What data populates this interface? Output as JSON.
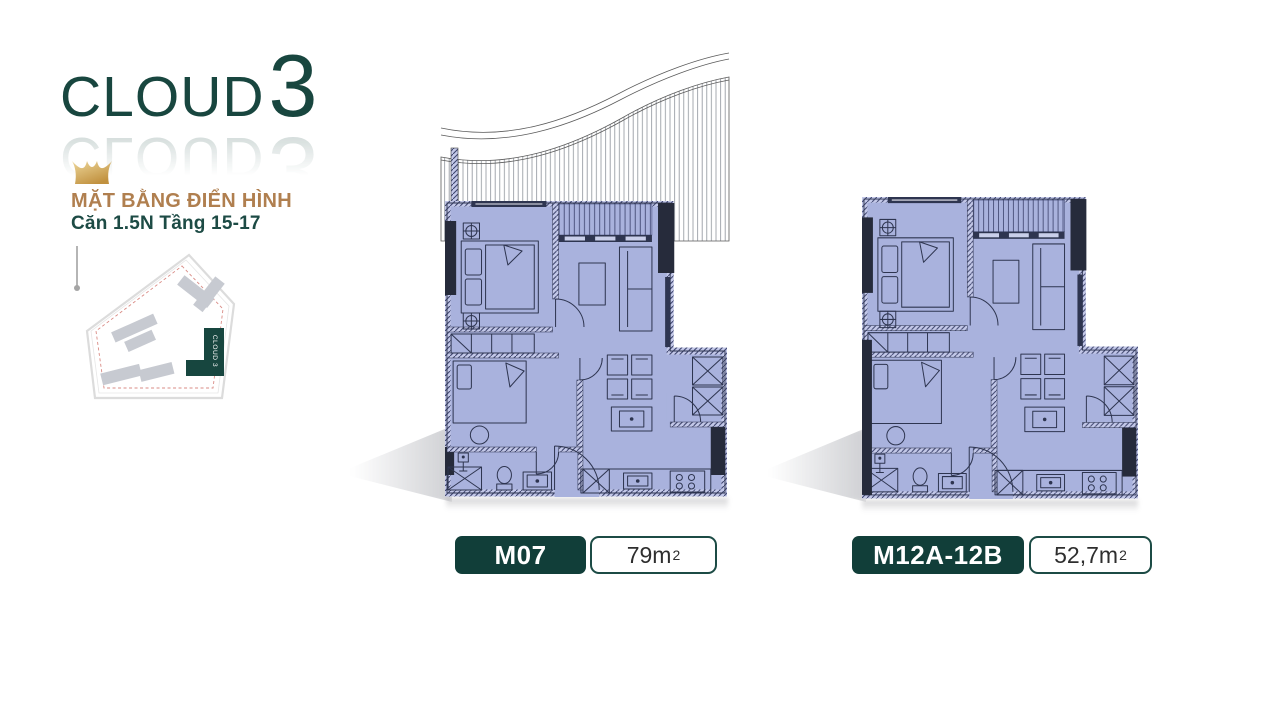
{
  "branding": {
    "logo_text": "CLOUD",
    "logo_number": "3",
    "title": "MẶT BẰNG ĐIỂN HÌNH",
    "subtitle": "Căn 1.5N Tầng 15-17",
    "site_plan_label": "CLOUD 3"
  },
  "units": [
    {
      "code": "M07",
      "area_value": "79m",
      "area_sup": "2"
    },
    {
      "code": "M12A-12B",
      "area_value": "52,7m",
      "area_sup": "2"
    }
  ],
  "colors": {
    "teal": "#17463F",
    "pill_teal": "#113E39",
    "gold_text": "#B07F4F",
    "crown_gold": "#D7B267",
    "plan_fill": "#A9B2DD",
    "plan_line": "#2E3550",
    "wall_dark": "#262B3B",
    "site_dashed": "#D98B85"
  }
}
